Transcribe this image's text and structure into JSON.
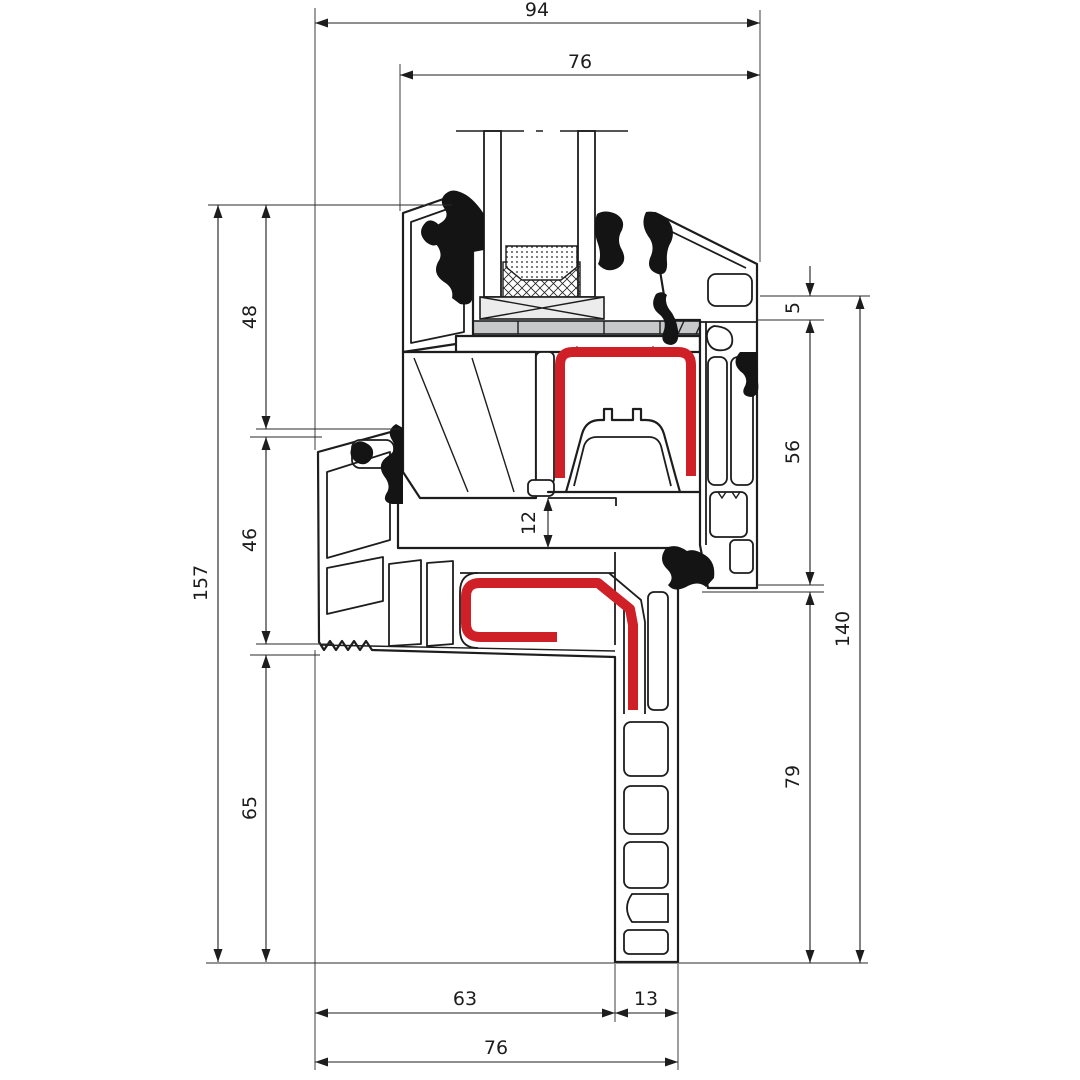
{
  "drawing": {
    "type": "window-profile-cross-section",
    "description": "Technical section drawing of a PVC window frame and sash profile with double glazing, dimension chains in mm"
  },
  "dims": {
    "top_total": "94",
    "top_inner": "76",
    "left_total": "157",
    "left_upper": "48",
    "left_middle": "46",
    "left_lower": "65",
    "right_step": "5",
    "right_upper": "56",
    "right_total": "140",
    "right_lower": "79",
    "center_gap": "12",
    "bottom_left": "63",
    "bottom_right": "13",
    "bottom_total": "76"
  },
  "colors": {
    "line": "#1d1d1d",
    "seal_red": "#ce2026",
    "glass_blue": "#d9e8f2",
    "block_gray": "#c6c8ca",
    "packer_gray": "#ececec",
    "gasket_black": "#141414",
    "background": "#ffffff"
  },
  "parts": [
    "frame-profile",
    "sash-profile",
    "glass-pane-left",
    "glass-pane-right",
    "edge-spacer",
    "sealant-crosshatch",
    "glazing-packer",
    "setting-block",
    "red-seal-upper",
    "red-seal-lower",
    "glass-gasket-left",
    "glass-gasket-right",
    "rebate-gasket-left",
    "frame-hook-gasket",
    "rebate-gasket-right",
    "serrated-anchor-edge",
    "hollow-chambers"
  ]
}
